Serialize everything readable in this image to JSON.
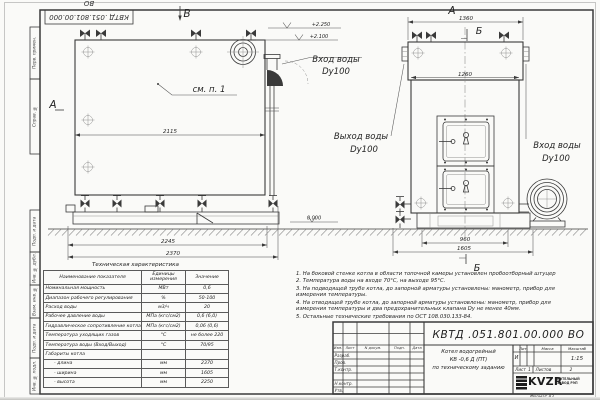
{
  "stamp": {
    "doc_number": "КВТД .051.801.00.000  ВО"
  },
  "margin": {
    "top_box_1": "Перв. примен.",
    "top_box_2": "Справ. №",
    "bottom_boxes": [
      "Подп. и дата",
      "Инв. № дубл.",
      "Взам. инв. №",
      "Подп. и дата",
      "Инв. № подл."
    ]
  },
  "views": {
    "left": {
      "cut_label_top": "В",
      "cut_label_side": "А",
      "see_item": "см. п. 1",
      "dim_inner_width": "2115",
      "dim_base": "2245",
      "dim_overall": "2370",
      "elevation_top": "+2.250",
      "elevation_mid": "+2.100",
      "elevation_zero": "0.000",
      "water_inlet_line1": "Вход воды",
      "water_inlet_line2": "Dy100"
    },
    "right": {
      "view_label": "А",
      "section_label_top": "Б",
      "section_label_bottom": "Б",
      "dim_overall_width": "1360",
      "dim_flange_width": "1260",
      "dim_base": "960",
      "dim_overall_base": "1605",
      "water_outlet_line1": "Выход воды",
      "water_outlet_line2": "Dy100",
      "water_inlet_line1": "Вход воды",
      "water_inlet_line2": "Dy100"
    }
  },
  "tech_table": {
    "title": "Техническая характеристика",
    "col_name": "Наименование показателя",
    "col_units": "Единицы измерения",
    "col_value": "Значение",
    "rows": [
      {
        "name": "Номинальная мощность",
        "unit": "МВт",
        "value": "0,6"
      },
      {
        "name": "Диапазон рабочего регулирования",
        "unit": "%",
        "value": "50-100"
      },
      {
        "name": "Расход воды",
        "unit": "м3/ч",
        "value": "20"
      },
      {
        "name": "Рабочее давление воды",
        "unit": "МПа (кгс/см2)",
        "value": "0,6 (6,0)"
      },
      {
        "name": "Гидравлическое сопротивление котла",
        "unit": "МПа (кгс/см2)",
        "value": "0,06 (0,6)"
      },
      {
        "name": "Температура уходящих газов",
        "unit": "°С",
        "value": "не более 220"
      },
      {
        "name": "Температура воды (Вход/Выход)",
        "unit": "°С",
        "value": "70/95"
      },
      {
        "name": "Габариты котла",
        "unit": "",
        "value": ""
      },
      {
        "name": "- длина",
        "unit": "мм",
        "value": "2370"
      },
      {
        "name": "- ширина",
        "unit": "мм",
        "value": "1605"
      },
      {
        "name": "- высота",
        "unit": "мм",
        "value": "2250"
      }
    ]
  },
  "notes": {
    "items": [
      "1.  На боковой стенке котла в области топочной камеры установлен пробоотборный штуцер",
      "2.  Температура воды на входе  70°С,  на выходе  95°С.",
      "3.  На подводящей трубе котла, до запорной арматуры установлены: манометр, прибор для измерения температуры.",
      "4.  На отводящей трубе котла, до запорной арматуры установлены: манометр, прибор для измерения температуры и два предохранительных клапана Dу не менее 40мм.",
      "5.  Остальные технические требования по ОСТ  108.030.133-84."
    ]
  },
  "title_block": {
    "doc_number": "КВТД .051.801.00.000  ВО",
    "product_line1": "Котел водогрейный",
    "product_line2": "КВ -0,6  Д  (ПТ)",
    "product_line3": "по техническому заданию",
    "col_izm": "Изм.",
    "col_list": "Лист",
    "col_docnum": "N докум.",
    "col_podp": "Подп.",
    "col_data": "Дата",
    "row_razrab": "Разраб.",
    "row_prov": "Пров.",
    "row_tkontr": "Т.контр.",
    "row_nkontr": "Н.контр.",
    "row_utv": "Утв.",
    "lit_label": "Лит.",
    "lit_value": "И",
    "mass_label": "Масса",
    "scale_label": "Масштаб",
    "scale_value": "1:15",
    "sheet_label": "Лист",
    "sheet_value": "1",
    "sheets_label": "Листов",
    "sheets_value": "2",
    "brand": "KVZR",
    "brand_sub1": "КОТЕЛЬНЫЙ",
    "brand_sub2": "ЗАВОД РЭП",
    "format_label": "Формат  А3"
  }
}
